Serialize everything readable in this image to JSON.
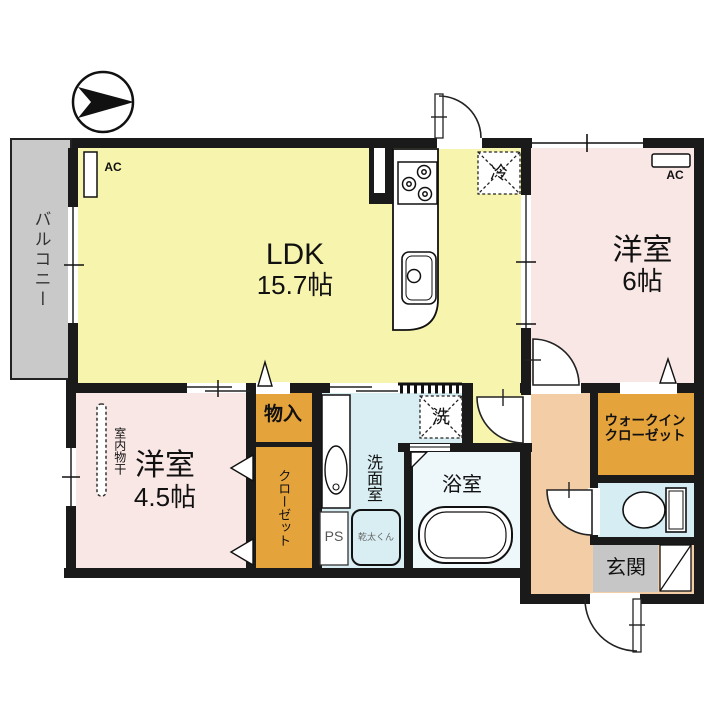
{
  "rooms": {
    "balcony": {
      "label": "バルコニー"
    },
    "ldk": {
      "label": "LDK",
      "size": "15.7帖"
    },
    "bedroom6": {
      "label": "洋室",
      "size": "6帖"
    },
    "bedroom45": {
      "label": "洋室",
      "size": "4.5帖"
    },
    "washroom": {
      "label": "洗面室"
    },
    "bathroom": {
      "label": "浴室"
    },
    "entrance": {
      "label": "玄関"
    },
    "wic": {
      "label_line1": "ウォークイン",
      "label_line2": "クローゼット"
    },
    "closet": {
      "label": "クローゼット"
    },
    "storage": {
      "label": "物入"
    }
  },
  "fixtures": {
    "ac_ldk": {
      "label": "AC"
    },
    "ac_bedroom6": {
      "label": "AC"
    },
    "fridge_space": {
      "label": "冷"
    },
    "washer_space": {
      "label": "洗"
    },
    "pipe_space": {
      "label": "PS"
    },
    "gas_dryer": {
      "label": "乾太くん"
    },
    "indoor_drying": {
      "label": "室内物干"
    }
  },
  "colors": {
    "ldk": "#f7f4ad",
    "bedroom": "#f9e7e5",
    "storage_orange": "#e5a33b",
    "hall": "#f2cda6",
    "washroom": "#d9eef3",
    "toilet": "#d5edf3",
    "bathroom": "#eef7fa",
    "balcony": "#c9c9c9",
    "entrance": "#c6c6c6",
    "wall": "#1a1a1a"
  }
}
